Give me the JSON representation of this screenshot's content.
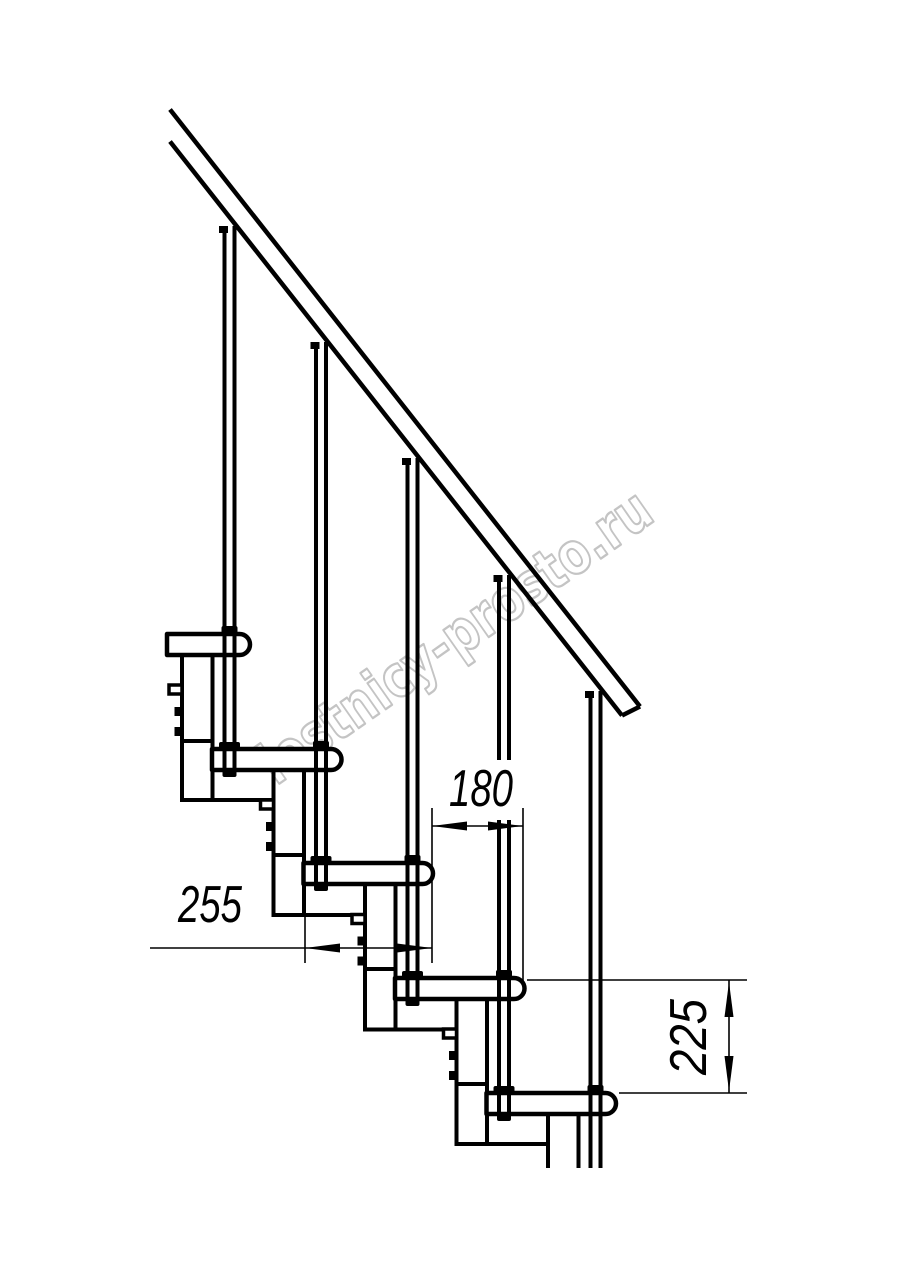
{
  "drawing": {
    "kind": "technical line drawing - modular staircase side elevation with handrail, balusters and stacked support modules",
    "background_color": "#ffffff",
    "line_color": "#000000"
  },
  "watermark": {
    "text": "lestnicy-prosto.ru",
    "outline_color": "#c4c4c4"
  },
  "dimensions": {
    "tread_depth": "255",
    "going": "180",
    "rise": "225"
  }
}
